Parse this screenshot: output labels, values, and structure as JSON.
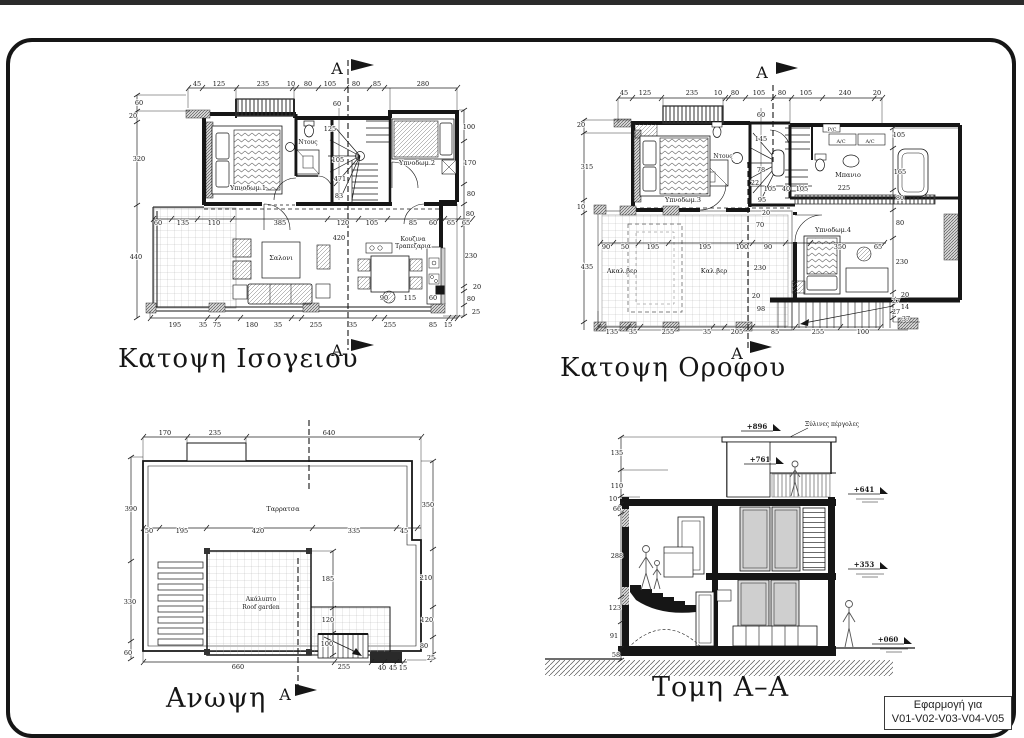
{
  "sheet": {
    "bg": "#ffffff",
    "line_color": "#161616",
    "label_box": {
      "line1": "Εφαρμογή για",
      "line2": "V01-V02-V03-V04-V05"
    }
  },
  "views": {
    "ground_floor": {
      "title": "Κατοψη Ισογειου",
      "labels": [
        {
          "t": "45",
          "x": 197,
          "y": 86
        },
        {
          "t": "125",
          "x": 219,
          "y": 86
        },
        {
          "t": "235",
          "x": 263,
          "y": 86
        },
        {
          "t": "10",
          "x": 291,
          "y": 86
        },
        {
          "t": "80",
          "x": 308,
          "y": 86
        },
        {
          "t": "105",
          "x": 330,
          "y": 86
        },
        {
          "t": "80",
          "x": 356,
          "y": 86
        },
        {
          "t": "85",
          "x": 377,
          "y": 86
        },
        {
          "t": "280",
          "x": 423,
          "y": 86
        },
        {
          "t": "60",
          "x": 139,
          "y": 105
        },
        {
          "t": "20",
          "x": 133,
          "y": 118
        },
        {
          "t": "320",
          "x": 139,
          "y": 161
        },
        {
          "t": "440",
          "x": 136,
          "y": 259
        },
        {
          "t": "100",
          "x": 469,
          "y": 129
        },
        {
          "t": "170",
          "x": 470,
          "y": 165
        },
        {
          "t": "80",
          "x": 471,
          "y": 196
        },
        {
          "t": "80",
          "x": 470,
          "y": 216
        },
        {
          "t": "230",
          "x": 471,
          "y": 258
        },
        {
          "t": "20",
          "x": 477,
          "y": 289
        },
        {
          "t": "80",
          "x": 471,
          "y": 301
        },
        {
          "t": "25",
          "x": 476,
          "y": 314
        },
        {
          "t": "195",
          "x": 175,
          "y": 327
        },
        {
          "t": "35",
          "x": 203,
          "y": 327
        },
        {
          "t": "75",
          "x": 217,
          "y": 327
        },
        {
          "t": "180",
          "x": 252,
          "y": 327
        },
        {
          "t": "35",
          "x": 278,
          "y": 327
        },
        {
          "t": "255",
          "x": 316,
          "y": 327
        },
        {
          "t": "35",
          "x": 353,
          "y": 327
        },
        {
          "t": "255",
          "x": 390,
          "y": 327
        },
        {
          "t": "85",
          "x": 433,
          "y": 327
        },
        {
          "t": "15",
          "x": 448,
          "y": 327
        },
        {
          "t": "60",
          "x": 158,
          "y": 225
        },
        {
          "t": "135",
          "x": 183,
          "y": 225
        },
        {
          "t": "110",
          "x": 214,
          "y": 225
        },
        {
          "t": "385",
          "x": 280,
          "y": 225
        },
        {
          "t": "120",
          "x": 343,
          "y": 225
        },
        {
          "t": "105",
          "x": 372,
          "y": 225
        },
        {
          "t": "85",
          "x": 413,
          "y": 225
        },
        {
          "t": "60",
          "x": 433,
          "y": 225
        },
        {
          "t": "65",
          "x": 451,
          "y": 225
        },
        {
          "t": "65",
          "x": 466,
          "y": 225
        },
        {
          "t": "60",
          "x": 337,
          "y": 106
        },
        {
          "t": "125",
          "x": 330,
          "y": 131
        },
        {
          "t": "105",
          "x": 338,
          "y": 162
        },
        {
          "t": "471",
          "x": 340,
          "y": 181
        },
        {
          "t": "83",
          "x": 339,
          "y": 198
        },
        {
          "t": "420",
          "x": 339,
          "y": 240
        },
        {
          "t": "90",
          "x": 384,
          "y": 300
        },
        {
          "t": "115",
          "x": 410,
          "y": 300
        },
        {
          "t": "60",
          "x": 433,
          "y": 300
        },
        {
          "t": "Υπνοδωμ.1",
          "x": 248,
          "y": 190,
          "n": "room-label"
        },
        {
          "t": "Ντους",
          "x": 308,
          "y": 144,
          "fs": 6,
          "n": "room-label"
        },
        {
          "t": "Υπνοδωμ.2",
          "x": 417,
          "y": 165,
          "n": "room-label"
        },
        {
          "t": "Σαλονι",
          "x": 281,
          "y": 260,
          "n": "room-label"
        },
        {
          "t": "Κουζινα",
          "x": 413,
          "y": 241,
          "fs": 6,
          "n": "room-label"
        },
        {
          "t": "Τραπεζαρια",
          "x": 413,
          "y": 248,
          "fs": 6,
          "n": "room-label"
        },
        {
          "t": "A",
          "x": 337,
          "y": 74,
          "fs": 16,
          "n": "section-letter"
        },
        {
          "t": "A",
          "x": 337,
          "y": 356,
          "fs": 16,
          "n": "section-letter"
        }
      ]
    },
    "upper_floor": {
      "title": "Κατοψη Οροφου",
      "labels": [
        {
          "t": "45",
          "x": 624,
          "y": 95
        },
        {
          "t": "125",
          "x": 645,
          "y": 95
        },
        {
          "t": "235",
          "x": 692,
          "y": 95
        },
        {
          "t": "10",
          "x": 718,
          "y": 95
        },
        {
          "t": "80",
          "x": 735,
          "y": 95
        },
        {
          "t": "105",
          "x": 759,
          "y": 95
        },
        {
          "t": "80",
          "x": 782,
          "y": 95
        },
        {
          "t": "105",
          "x": 806,
          "y": 95
        },
        {
          "t": "240",
          "x": 845,
          "y": 95
        },
        {
          "t": "20",
          "x": 877,
          "y": 95
        },
        {
          "t": "20",
          "x": 581,
          "y": 127
        },
        {
          "t": "315",
          "x": 587,
          "y": 169
        },
        {
          "t": "10",
          "x": 581,
          "y": 209
        },
        {
          "t": "435",
          "x": 587,
          "y": 269
        },
        {
          "t": "105",
          "x": 899,
          "y": 137
        },
        {
          "t": "165",
          "x": 900,
          "y": 174
        },
        {
          "t": "80",
          "x": 900,
          "y": 200
        },
        {
          "t": "80",
          "x": 900,
          "y": 225
        },
        {
          "t": "230",
          "x": 902,
          "y": 264
        },
        {
          "t": "20",
          "x": 905,
          "y": 297
        },
        {
          "t": "27",
          "x": 896,
          "y": 303
        },
        {
          "t": "14",
          "x": 905,
          "y": 309
        },
        {
          "t": "27",
          "x": 896,
          "y": 314
        },
        {
          "t": "37",
          "x": 906,
          "y": 321
        },
        {
          "t": "135",
          "x": 612,
          "y": 334
        },
        {
          "t": "35",
          "x": 633,
          "y": 334
        },
        {
          "t": "255",
          "x": 668,
          "y": 334
        },
        {
          "t": "35",
          "x": 707,
          "y": 334
        },
        {
          "t": "205",
          "x": 737,
          "y": 334
        },
        {
          "t": "85",
          "x": 775,
          "y": 334
        },
        {
          "t": "255",
          "x": 818,
          "y": 334
        },
        {
          "t": "100",
          "x": 863,
          "y": 334
        },
        {
          "t": "90",
          "x": 606,
          "y": 249
        },
        {
          "t": "50",
          "x": 625,
          "y": 249
        },
        {
          "t": "195",
          "x": 653,
          "y": 249
        },
        {
          "t": "195",
          "x": 705,
          "y": 249
        },
        {
          "t": "100",
          "x": 742,
          "y": 249
        },
        {
          "t": "90",
          "x": 768,
          "y": 249
        },
        {
          "t": "350",
          "x": 840,
          "y": 249
        },
        {
          "t": "65",
          "x": 878,
          "y": 249
        },
        {
          "t": "60",
          "x": 761,
          "y": 117
        },
        {
          "t": "145",
          "x": 761,
          "y": 141
        },
        {
          "t": "78",
          "x": 761,
          "y": 172
        },
        {
          "t": "22",
          "x": 755,
          "y": 185
        },
        {
          "t": "105",
          "x": 770,
          "y": 191
        },
        {
          "t": "40",
          "x": 786,
          "y": 191
        },
        {
          "t": "105",
          "x": 802,
          "y": 191
        },
        {
          "t": "95",
          "x": 762,
          "y": 202
        },
        {
          "t": "225",
          "x": 844,
          "y": 190
        },
        {
          "t": "20",
          "x": 766,
          "y": 215
        },
        {
          "t": "70",
          "x": 760,
          "y": 227
        },
        {
          "t": "230",
          "x": 760,
          "y": 270
        },
        {
          "t": "20",
          "x": 756,
          "y": 298
        },
        {
          "t": "98",
          "x": 761,
          "y": 311
        },
        {
          "t": "Υπνοδωμ.3",
          "x": 683,
          "y": 202,
          "n": "room-label"
        },
        {
          "t": "Ντους",
          "x": 723,
          "y": 158,
          "fs": 6,
          "n": "room-label"
        },
        {
          "t": "Μπανιο",
          "x": 848,
          "y": 177,
          "n": "room-label"
        },
        {
          "t": "Υπνοδωμ.4",
          "x": 833,
          "y": 232,
          "n": "room-label"
        },
        {
          "t": "Ακαλ.βερ",
          "x": 622,
          "y": 273,
          "n": "room-label"
        },
        {
          "t": "Καλ.βερ",
          "x": 714,
          "y": 273,
          "n": "room-label"
        },
        {
          "t": "P/C",
          "x": 832,
          "y": 131,
          "fs": 5,
          "n": "equipment-label"
        },
        {
          "t": "A/C",
          "x": 841,
          "y": 143,
          "fs": 5,
          "n": "equipment-label"
        },
        {
          "t": "A/C",
          "x": 870,
          "y": 143,
          "fs": 5,
          "n": "equipment-label"
        },
        {
          "t": "A",
          "x": 762,
          "y": 78,
          "fs": 16,
          "n": "section-letter"
        },
        {
          "t": "A",
          "x": 737,
          "y": 359,
          "fs": 16,
          "n": "section-letter"
        }
      ]
    },
    "roof": {
      "title": "Ανωψη",
      "labels": [
        {
          "t": "170",
          "x": 165,
          "y": 435
        },
        {
          "t": "235",
          "x": 215,
          "y": 435
        },
        {
          "t": "640",
          "x": 329,
          "y": 435
        },
        {
          "t": "390",
          "x": 131,
          "y": 511
        },
        {
          "t": "330",
          "x": 130,
          "y": 604
        },
        {
          "t": "60",
          "x": 128,
          "y": 655
        },
        {
          "t": "350",
          "x": 428,
          "y": 507
        },
        {
          "t": "210",
          "x": 426,
          "y": 580
        },
        {
          "t": "120",
          "x": 427,
          "y": 622
        },
        {
          "t": "80",
          "x": 424,
          "y": 648
        },
        {
          "t": "25",
          "x": 431,
          "y": 660
        },
        {
          "t": "50",
          "x": 149,
          "y": 533
        },
        {
          "t": "195",
          "x": 182,
          "y": 533
        },
        {
          "t": "420",
          "x": 258,
          "y": 533
        },
        {
          "t": "335",
          "x": 354,
          "y": 533
        },
        {
          "t": "45",
          "x": 404,
          "y": 533
        },
        {
          "t": "185",
          "x": 328,
          "y": 581
        },
        {
          "t": "120",
          "x": 328,
          "y": 622
        },
        {
          "t": "100",
          "x": 327,
          "y": 646
        },
        {
          "t": "660",
          "x": 238,
          "y": 669
        },
        {
          "t": "255",
          "x": 344,
          "y": 669
        },
        {
          "t": "40",
          "x": 382,
          "y": 670
        },
        {
          "t": "45",
          "x": 393,
          "y": 670
        },
        {
          "t": "15",
          "x": 403,
          "y": 670
        },
        {
          "t": "Ταρρατσα",
          "x": 283,
          "y": 511,
          "n": "room-label"
        },
        {
          "t": "Ακάλυπτο",
          "x": 261,
          "y": 601,
          "fs": 6,
          "n": "room-label"
        },
        {
          "t": "Roof garden",
          "x": 261,
          "y": 609,
          "fs": 6,
          "n": "room-label"
        },
        {
          "t": "A",
          "x": 285,
          "y": 700,
          "fs": 16,
          "n": "section-letter"
        }
      ]
    },
    "section": {
      "title": "Τομη Α–Α",
      "labels": [
        {
          "t": "+896",
          "x": 757,
          "y": 429,
          "fs": 7,
          "w": "bold",
          "n": "elevation-mark"
        },
        {
          "t": "+761",
          "x": 760,
          "y": 462,
          "fs": 7,
          "w": "bold",
          "n": "elevation-mark"
        },
        {
          "t": "+641",
          "x": 864,
          "y": 492,
          "fs": 7,
          "w": "bold",
          "n": "elevation-mark"
        },
        {
          "t": "+353",
          "x": 864,
          "y": 567,
          "fs": 7,
          "w": "bold",
          "n": "elevation-mark"
        },
        {
          "t": "+060",
          "x": 888,
          "y": 642,
          "fs": 7,
          "w": "bold",
          "n": "elevation-mark"
        },
        {
          "t": "Ξύλινες πέργολες",
          "x": 832,
          "y": 426,
          "fs": 6,
          "n": "annotation"
        },
        {
          "t": "135",
          "x": 617,
          "y": 455
        },
        {
          "t": "110",
          "x": 617,
          "y": 488
        },
        {
          "t": "10",
          "x": 613,
          "y": 501
        },
        {
          "t": "66",
          "x": 617,
          "y": 511
        },
        {
          "t": "288",
          "x": 617,
          "y": 558
        },
        {
          "t": "123",
          "x": 615,
          "y": 610
        },
        {
          "t": "91",
          "x": 614,
          "y": 638
        },
        {
          "t": "58",
          "x": 616,
          "y": 657
        }
      ]
    }
  }
}
